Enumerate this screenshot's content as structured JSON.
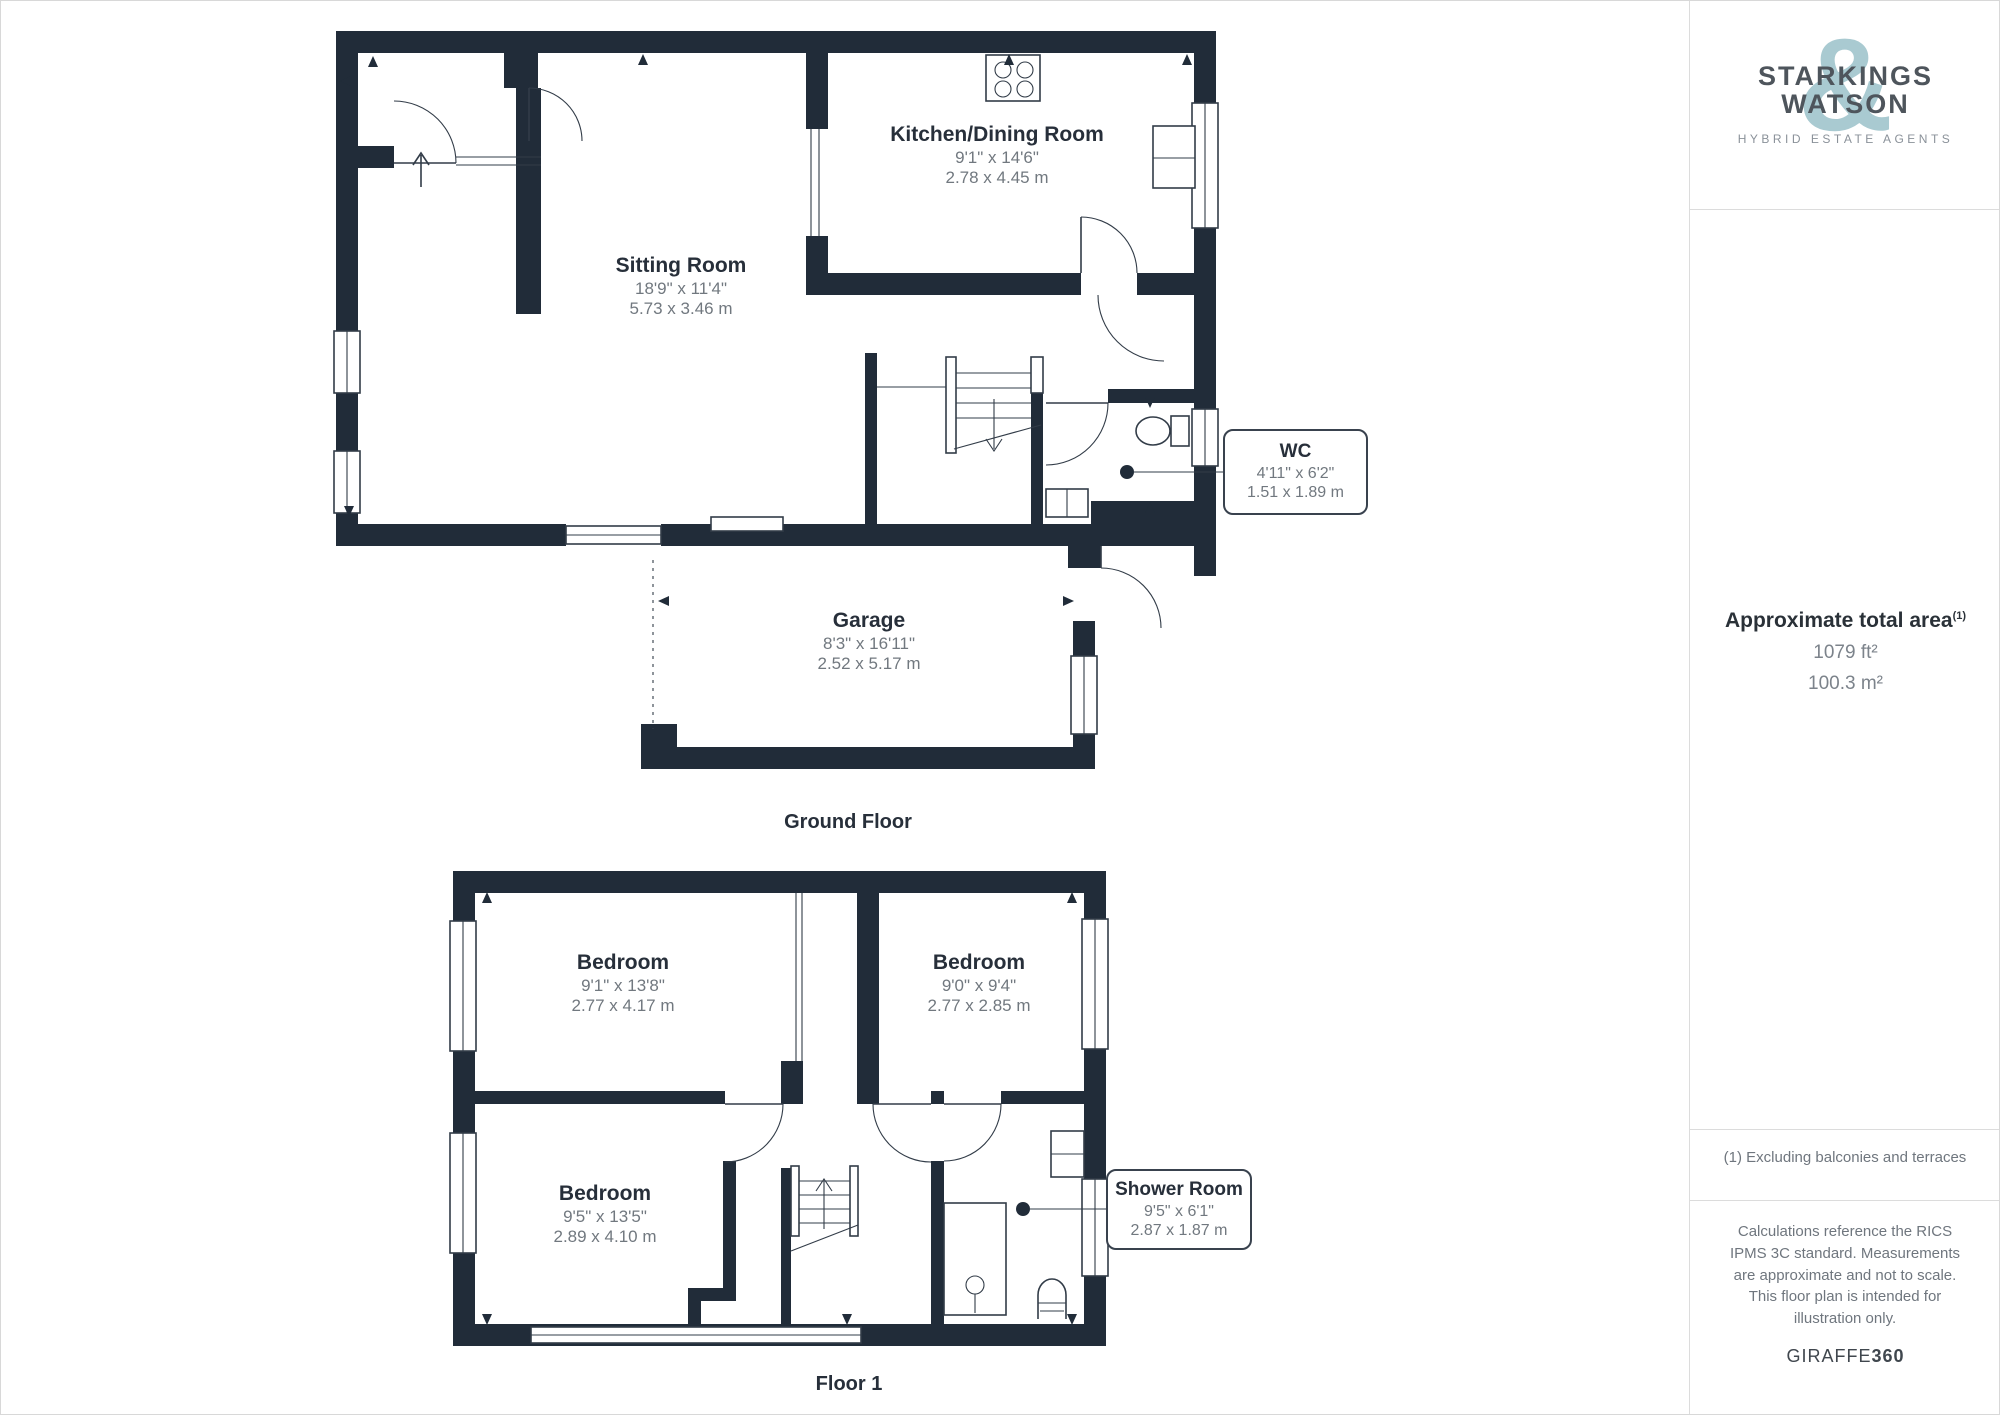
{
  "colors": {
    "wall": "#212c39",
    "line": "#323c48",
    "logo_accent": "#a9cad1",
    "text_dark": "#272f3a",
    "text_gray": "#71787f",
    "divider": "#dcdcdc"
  },
  "sidebar": {
    "logo": {
      "line1": "STARKINGS",
      "line2": "WATSON",
      "ampersand": "&",
      "tagline": "HYBRID ESTATE AGENTS"
    },
    "total_area": {
      "title": "Approximate total area",
      "footnote_ref": "(1)",
      "imperial": "1079 ft²",
      "metric": "100.3 m²"
    },
    "footnote": "(1) Excluding balconies and terraces",
    "disclaimer": "Calculations reference the RICS IPMS 3C standard. Measurements are approximate and not to scale. This floor plan is intended for illustration only.",
    "watermark": {
      "brand": "GIRAFFE",
      "suffix": "360"
    }
  },
  "ground_floor": {
    "title": "Ground Floor",
    "rooms": {
      "sitting": {
        "name": "Sitting Room",
        "imperial": "18'9\" x 11'4\"",
        "metric": "5.73 x 3.46 m"
      },
      "kitchen": {
        "name": "Kitchen/Dining Room",
        "imperial": "9'1\" x 14'6\"",
        "metric": "2.78 x 4.45 m"
      },
      "garage": {
        "name": "Garage",
        "imperial": "8'3\" x 16'11\"",
        "metric": "2.52 x 5.17 m"
      },
      "wc": {
        "name": "WC",
        "imperial": "4'11\" x 6'2\"",
        "metric": "1.51 x 1.89 m"
      }
    }
  },
  "floor_1": {
    "title": "Floor 1",
    "rooms": {
      "bedroom1": {
        "name": "Bedroom",
        "imperial": "9'1\" x 13'8\"",
        "metric": "2.77 x 4.17 m"
      },
      "bedroom2": {
        "name": "Bedroom",
        "imperial": "9'0\" x 9'4\"",
        "metric": "2.77 x 2.85 m"
      },
      "bedroom3": {
        "name": "Bedroom",
        "imperial": "9'5\" x 13'5\"",
        "metric": "2.89 x 4.10 m"
      },
      "shower": {
        "name": "Shower Room",
        "imperial": "9'5\" x 6'1\"",
        "metric": "2.87 x 1.87 m"
      }
    }
  }
}
